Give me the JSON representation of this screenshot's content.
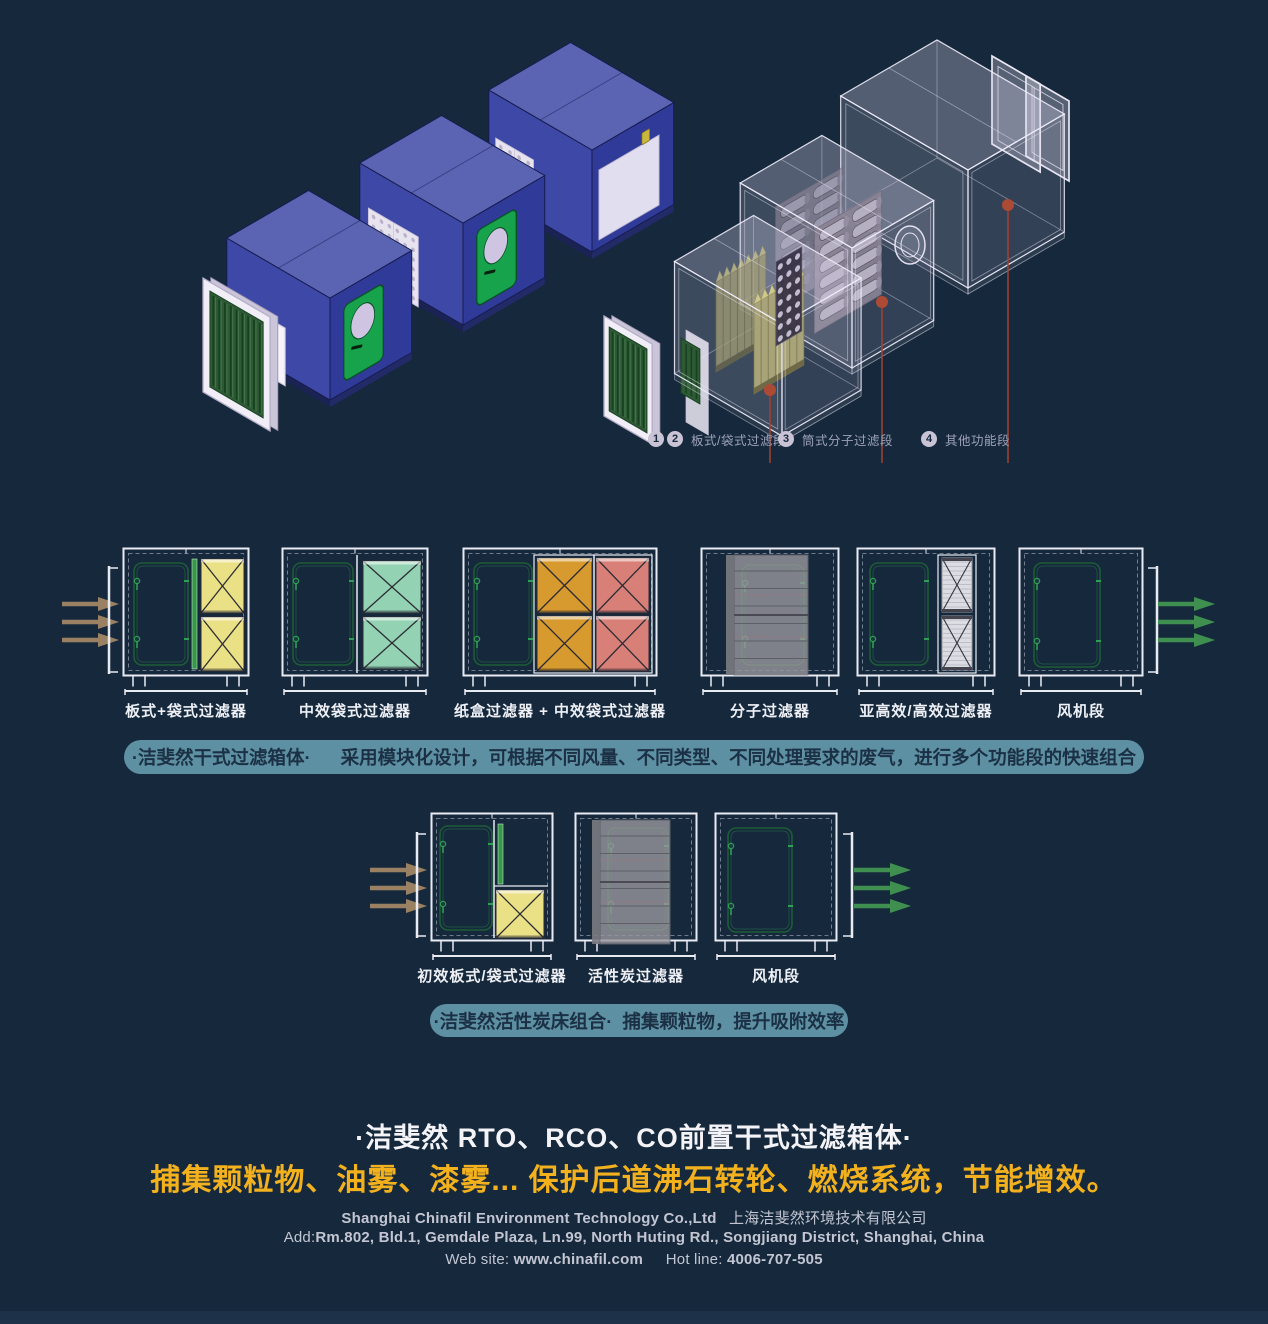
{
  "hero": {
    "callouts": [
      {
        "nums": [
          "1",
          "2"
        ],
        "label": "板式/袋式过滤段"
      },
      {
        "nums": [
          "3"
        ],
        "label": "筒式分子过滤段"
      },
      {
        "nums": [
          "4"
        ],
        "label": "其他功能段"
      }
    ]
  },
  "row1": {
    "inlet_arrow_color": "#9b8164",
    "outlet_arrow_color": "#3f8f50",
    "modules": [
      {
        "variant": "plate_bag",
        "label": "板式+袋式过滤器",
        "panel_color": "#eae186"
      },
      {
        "variant": "bag2",
        "label": "中效袋式过滤器",
        "panel_color": "#93d2b2"
      },
      {
        "variant": "box_bag4",
        "label": "纸盒过滤器 + 中效袋式过滤器",
        "panel_color": "#d79a2e",
        "panel_color2": "#d88077"
      },
      {
        "variant": "molecular",
        "label": "分子过滤器",
        "panel_color": "#98989d"
      },
      {
        "variant": "hepa",
        "label": "亚高效/高效过滤器",
        "panel_color": "#dcdce3"
      },
      {
        "variant": "fan",
        "label": "风机段"
      }
    ]
  },
  "banner1": {
    "title": "·洁斐然干式过滤箱体·",
    "text": "采用模块化设计，可根据不同风量、不同类型、不同处理要求的废气，进行多个功能段的快速组合"
  },
  "row2": {
    "inlet_arrow_color": "#9b8164",
    "outlet_arrow_color": "#3f8f50",
    "modules": [
      {
        "variant": "pre_filter",
        "label": "初效板式/袋式过滤器",
        "panel_color": "#eae186"
      },
      {
        "variant": "carbon",
        "label": "活性炭过滤器",
        "panel_color": "#98989d"
      },
      {
        "variant": "fan2",
        "label": "风机段"
      }
    ]
  },
  "banner2": {
    "title": "·洁斐然活性炭床组合·",
    "text": "捕集颗粒物，提升吸附效率"
  },
  "footer": {
    "headline": "·洁斐然 RTO、RCO、CO前置干式过滤箱体·",
    "tagline": "捕集颗粒物、油雾、漆雾...  保护后道沸石转轮、燃烧系统，节能增效。",
    "company_en": "Shanghai Chinafil Environment Technology Co.,Ltd",
    "company_cn": "上海洁斐然环境技术有限公司",
    "address_label": "Add:",
    "address": "Rm.802, Bld.1, Gemdale Plaza, Ln.99, North Huting Rd., Songjiang District, Shanghai, China",
    "website_label": "Web site:",
    "website": "www.chinafil.com",
    "hotline_label": "Hot line:",
    "hotline": "4006-707-505"
  },
  "colors": {
    "background": "#16293c",
    "banner": "#5e90a3",
    "accent_yellow": "#f2b11d",
    "callout_red": "#a5402f",
    "door_green": "#1d5c36"
  }
}
